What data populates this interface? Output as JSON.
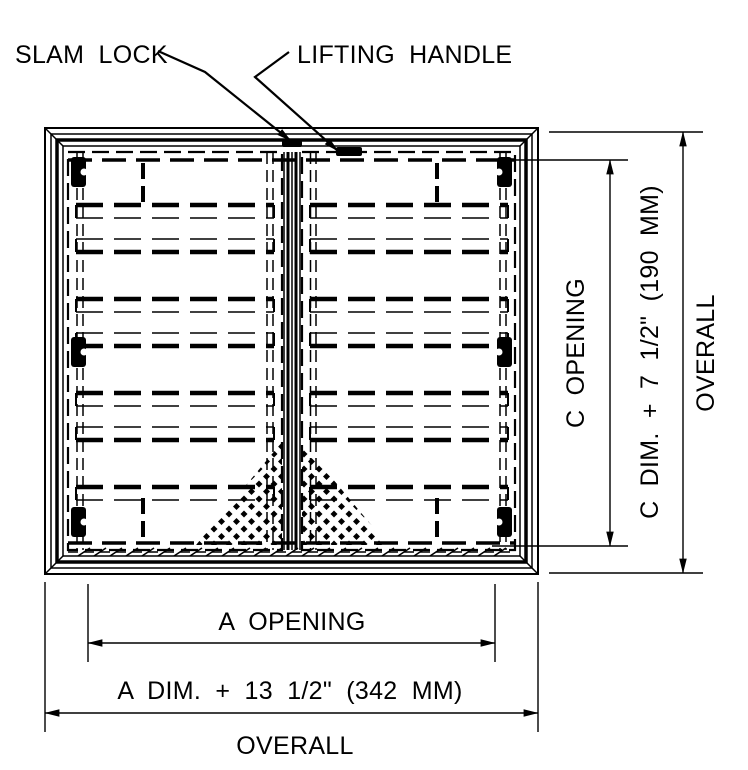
{
  "drawing": {
    "callouts": {
      "slam_lock": "SLAM LOCK",
      "lifting_handle": "LIFTING HANDLE"
    },
    "dimensions": {
      "vertical": {
        "opening_label": "C OPENING",
        "overall_formula": "C DIM. + 7 1/2\" (190 MM)",
        "overall_label": "OVERALL"
      },
      "horizontal": {
        "opening_label": "A OPENING",
        "overall_formula": "A DIM. + 13 1/2\" (342 MM)",
        "overall_label": "OVERALL"
      }
    },
    "colors": {
      "line": "#000000",
      "background": "#ffffff"
    }
  }
}
